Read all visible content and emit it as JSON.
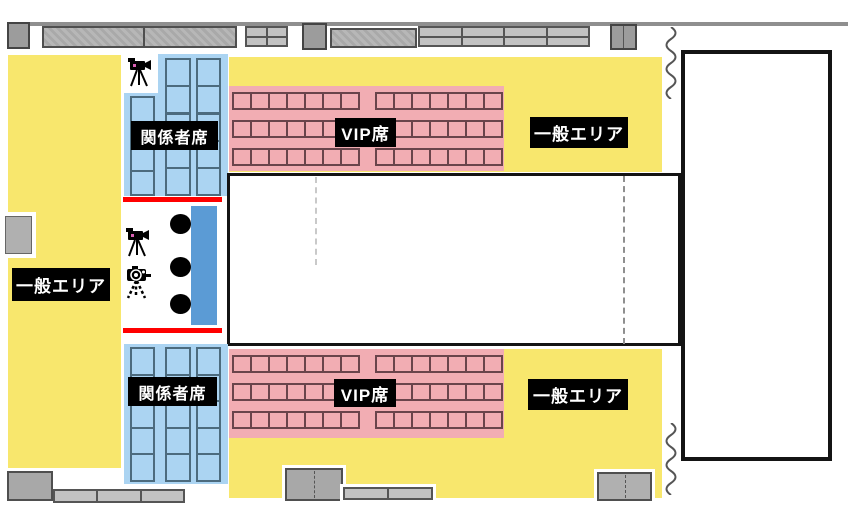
{
  "map": {
    "title": "venue seating floor map",
    "areas": {
      "general_left": {
        "label": "一般エリア",
        "type": "general"
      },
      "general_top": {
        "label": "一般エリア",
        "type": "general"
      },
      "general_bottom": {
        "label": "一般エリア",
        "type": "general"
      },
      "staff_top": {
        "label": "関係者席",
        "type": "staff-seating"
      },
      "staff_bottom": {
        "label": "関係者席",
        "type": "staff-seating"
      },
      "vip_top": {
        "label": "VIP席",
        "type": "vip-seating"
      },
      "vip_bottom": {
        "label": "VIP席",
        "type": "vip-seating"
      }
    },
    "icons": {
      "video_cameras": 2,
      "tripod_camera": 1,
      "commentator_dots": 3
    },
    "legend_colors": {
      "general_area_yellow": "#F8E76D",
      "vip_pink": "#F2ADB3",
      "vip_seat_border": "#6A444B",
      "staff_blue": "#ABD4F2",
      "staff_seat_border": "#4C6B7E",
      "camera_platform_blue": "#5B9BD5",
      "media_line_red": "#FF0000",
      "label_bg": "#000000",
      "label_text": "#FFFFFF"
    }
  }
}
